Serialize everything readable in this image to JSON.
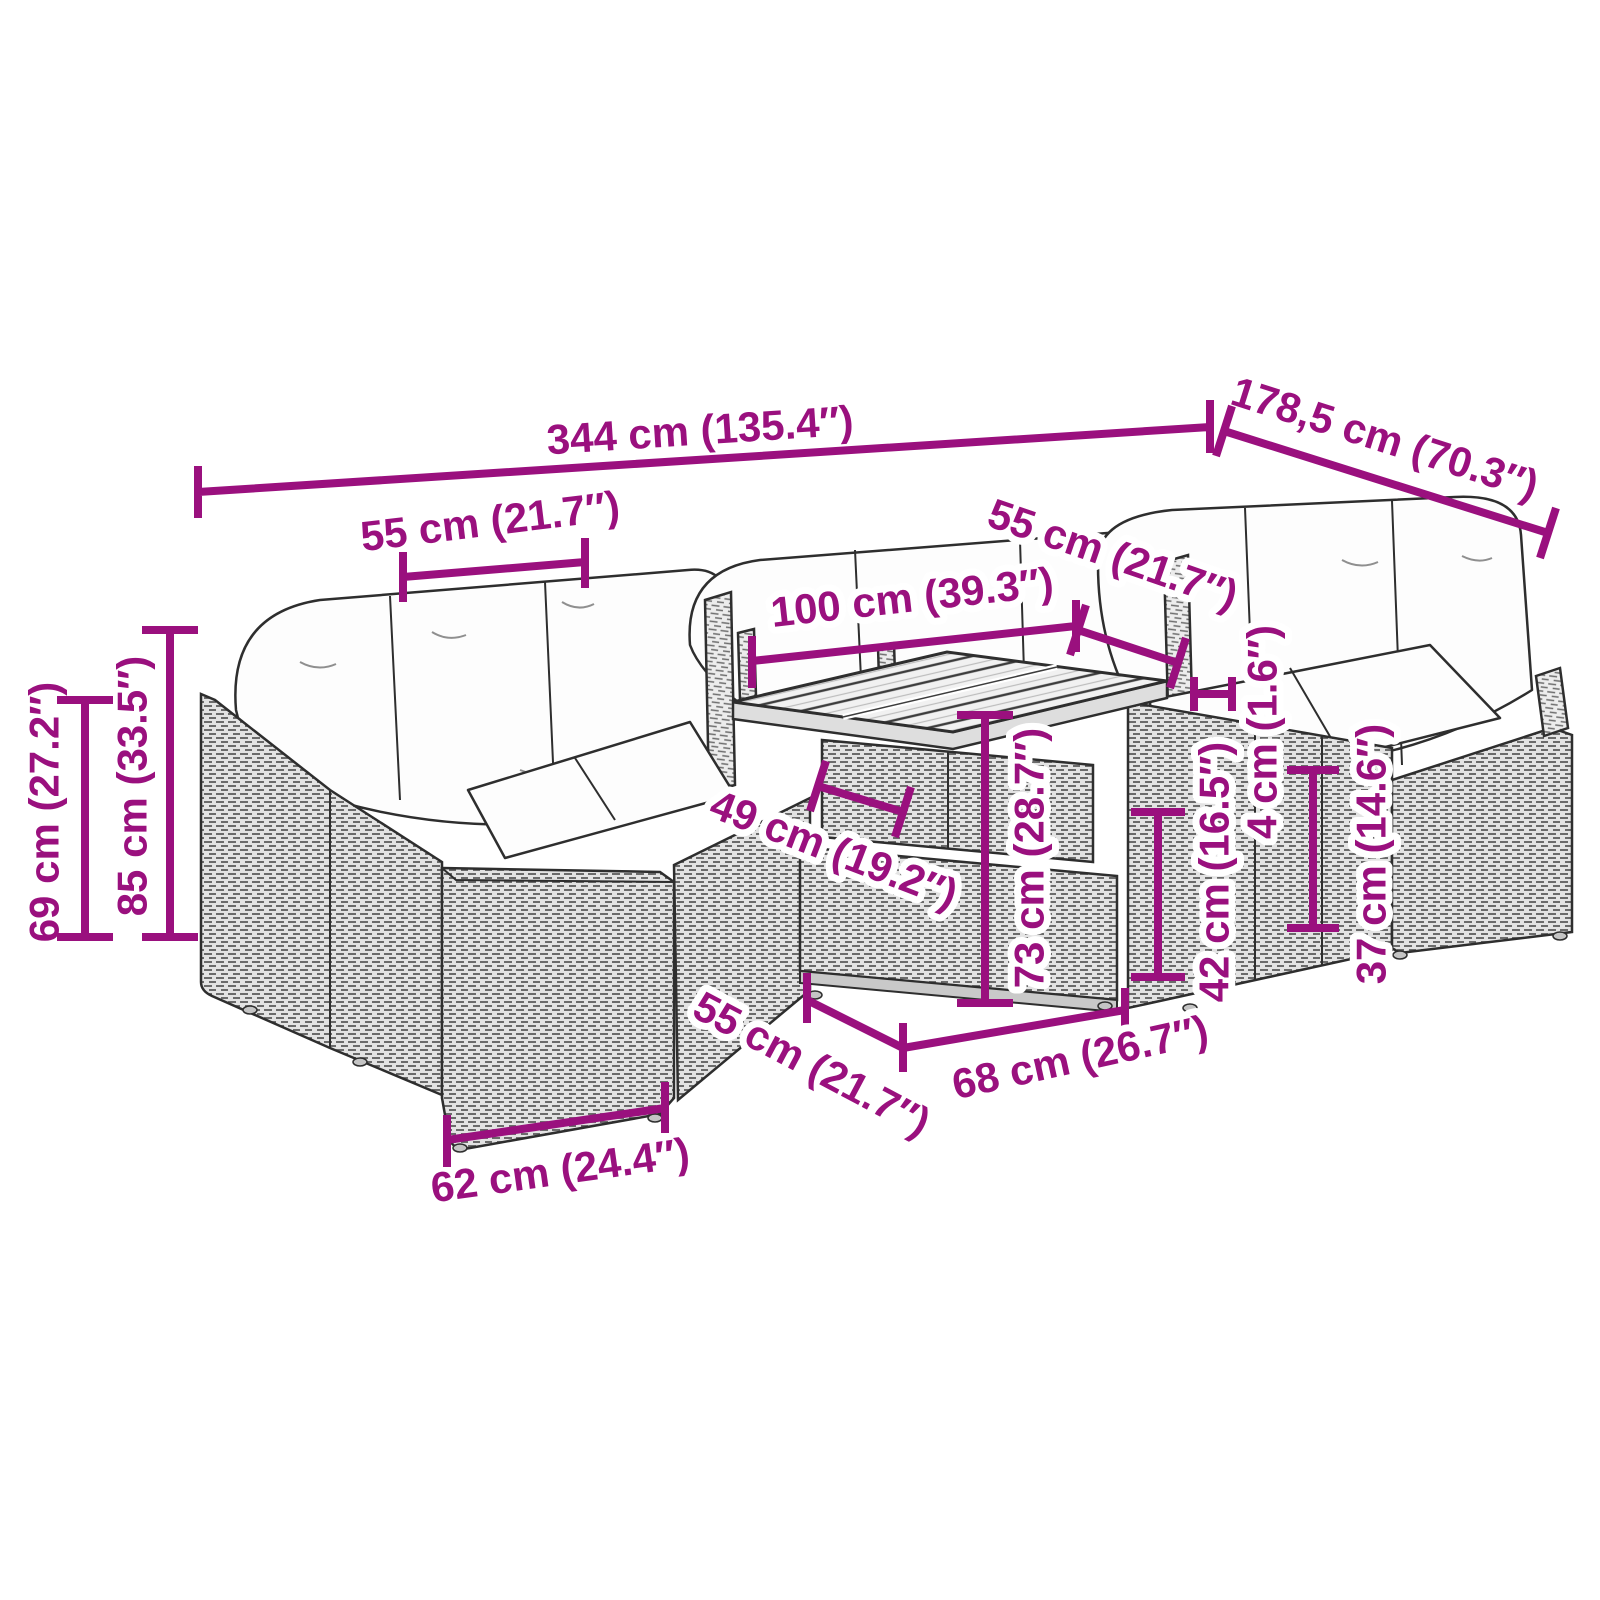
{
  "colors": {
    "dimension_accent": "#9A107E",
    "background": "#FFFFFF"
  },
  "dims": {
    "overall_width": "344 cm (135.4″)",
    "overall_depth": "178,5 cm (70.3″)",
    "back_cushion_left": "55 cm (21.7″)",
    "table_length": "100 cm (39.3″)",
    "back_cushion_right": "55 cm (21.7″)",
    "height_69": "69 cm (27.2″)",
    "height_85": "85 cm (33.5″)",
    "table_depth_49": "49 cm (19.2″)",
    "table_height_73": "73 cm (28.7″)",
    "top_thickness_4": "4 cm (1.6″)",
    "seat_height_42": "42 cm (16.5″)",
    "height_37": "37 cm (14.6″)",
    "seat_depth_55": "55 cm (21.7″)",
    "base_depth_68": "68 cm (26.7″)",
    "module_width_62": "62 cm (24.4″)"
  }
}
